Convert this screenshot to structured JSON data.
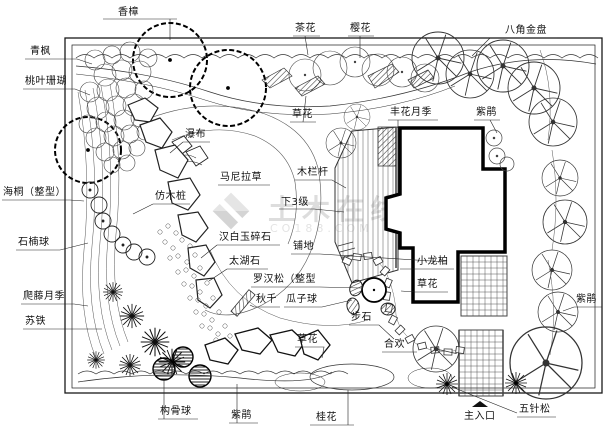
{
  "watermark": {
    "line1": "土木在线",
    "line2": "CO188.COM"
  },
  "labels": {
    "xiangzhang": "香樟",
    "qingfeng": "青枫",
    "taoyeshanhu": "桃叶珊瑚",
    "chahua": "茶花",
    "yinghua": "樱花",
    "bajiaojinpan": "八角金盘",
    "caohua_top": "草花",
    "fenghuayueji": "丰花月季",
    "zijuan_top": "紫鹃",
    "pubu": "瀑布",
    "manilacao": "马尼拉草",
    "fangmuzhuang": "仿木桩",
    "mulangan": "木栏杆",
    "xiasanji": "下3级",
    "haitong": "海桐（整型）",
    "hanbaiyusuishi": "汉白玉碎石",
    "pudi": "铺地",
    "shinanqiu": "石楠球",
    "taihushi": "太湖石",
    "xiaolongbai": "小龙柏",
    "luohansong": "罗汉松（整型",
    "caohua_mid": "草花",
    "patengyueji": "爬藤月季",
    "qiuqian": "秋千",
    "guaziqiu": "瓜子球",
    "bushi": "步石",
    "sutie": "苏铁",
    "caohua_bottom": "草花",
    "hehuan": "合欢",
    "zijuan_right": "紫鹃",
    "zijuan_bottom": "紫鹃",
    "gouguqiu": "构骨球",
    "guihua": "桂花",
    "zhurukou": "主入口",
    "wuzhensong": "五针松"
  }
}
